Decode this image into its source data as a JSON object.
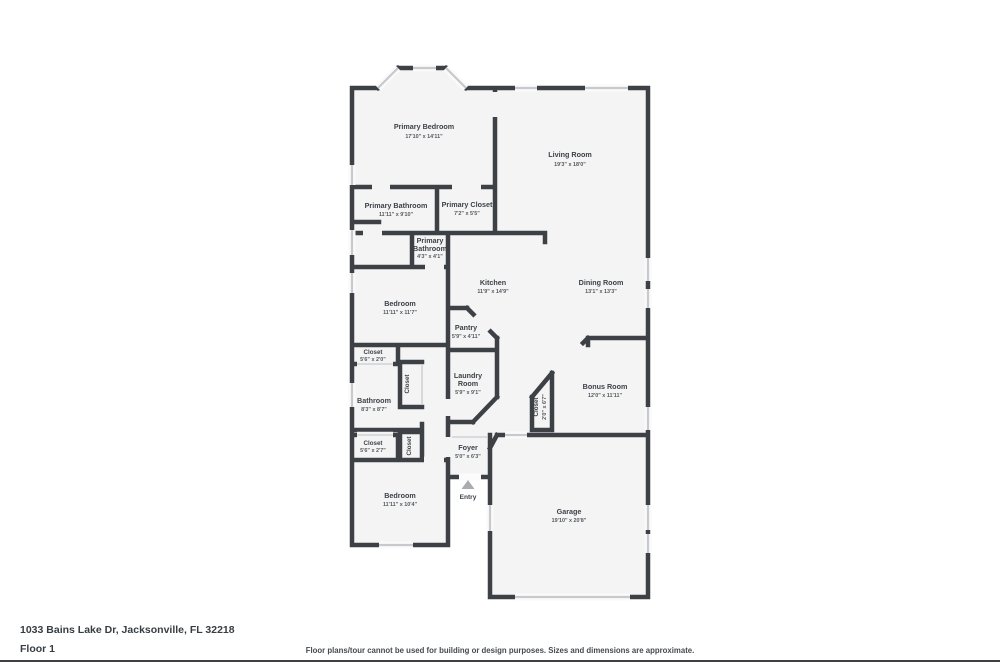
{
  "address": "1033 Bains Lake Dr, Jacksonville, FL 32218",
  "floor_label": "Floor 1",
  "disclaimer": "Floor plans/tour cannot be used for building or design purposes. Sizes and dimensions are approximate.",
  "colors": {
    "wall": "#3d4146",
    "room_fill": "#f4f4f5",
    "window": "#c7c9cc",
    "label_text": "#3d4247",
    "dims_text": "#54595e"
  },
  "rooms": {
    "primary_bedroom": {
      "name": "Primary Bedroom",
      "dims": "17'10\" x 14'11\""
    },
    "living_room": {
      "name": "Living Room",
      "dims": "19'3\" x 18'0\""
    },
    "primary_bathroom": {
      "name": "Primary Bathroom",
      "dims": "11'11\" x 9'10\""
    },
    "primary_closet": {
      "name": "Primary Closet",
      "dims": "7'2\" x 5'5\""
    },
    "primary_bathroom_2": {
      "name_lines": [
        "Primary",
        "Bathroom"
      ],
      "dims": "4'3\" x 4'1\""
    },
    "kitchen": {
      "name": "Kitchen",
      "dims": "11'9\" x 14'9\""
    },
    "dining_room": {
      "name": "Dining Room",
      "dims": "13'1\" x 13'3\""
    },
    "bedroom_2": {
      "name": "Bedroom",
      "dims": "11'11\" x 11'7\""
    },
    "pantry": {
      "name": "Pantry",
      "dims": "5'9\" x 4'11\""
    },
    "closet_1": {
      "name": "Closet",
      "dims": "5'6\" x 2'0\""
    },
    "laundry_room": {
      "name_lines": [
        "Laundry",
        "Room"
      ],
      "dims": "5'9\" x 9'1\""
    },
    "bonus_room": {
      "name": "Bonus Room",
      "dims": "12'0\" x 11'11\""
    },
    "hall_closet_1": {
      "name": "Closet"
    },
    "bathroom_2": {
      "name": "Bathroom",
      "dims": "8'3\" x 8'7\""
    },
    "closet_2": {
      "name": "Closet",
      "dims": "5'6\" x 2'7\""
    },
    "hall_closet_2": {
      "name": "Closet"
    },
    "bonus_closet": {
      "name": "Closet",
      "dims": "2'0\" x 6'7\""
    },
    "foyer": {
      "name": "Foyer",
      "dims": "5'0\" x 6'3\""
    },
    "entry": {
      "name": "Entry"
    },
    "bedroom_3": {
      "name": "Bedroom",
      "dims": "11'11\" x 10'4\""
    },
    "garage": {
      "name": "Garage",
      "dims": "19'10\" x 20'8\""
    }
  }
}
